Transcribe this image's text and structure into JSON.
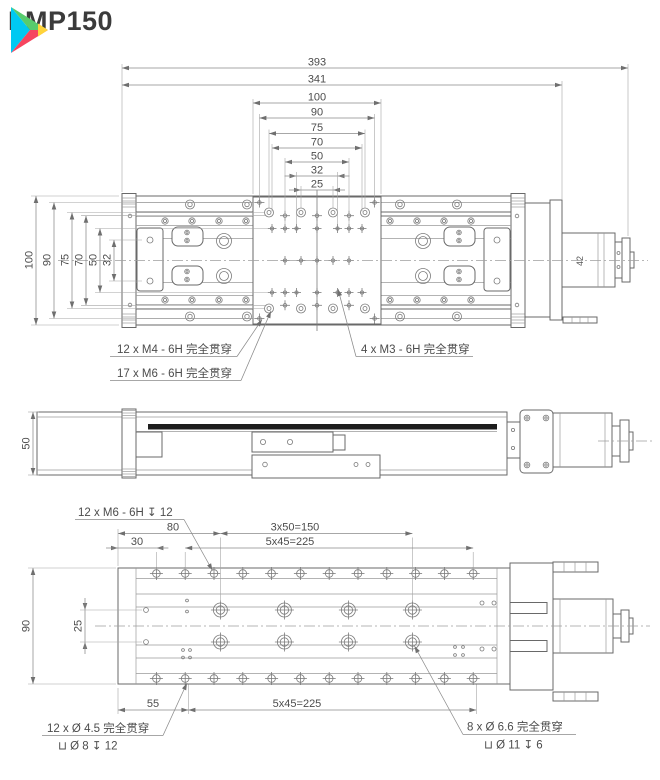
{
  "header": {
    "title": "LMP150",
    "logo_colors": {
      "cyan": "#00c9f2",
      "green": "#57cc6d",
      "yellow": "#ffd43a",
      "red": "#f6455f"
    }
  },
  "views": {
    "top": {
      "hdims": [
        "393",
        "341",
        "100",
        "90",
        "75",
        "70",
        "50",
        "32",
        "25"
      ],
      "vdims": [
        "100",
        "90",
        "75",
        "70",
        "50",
        "32"
      ],
      "notes": [
        "12 x  M4 - 6H 完全贯穿",
        "17 x  M6 - 6H 完全贯穿",
        "4 x  M3 - 6H 完全贯穿"
      ],
      "motor_label": "42"
    },
    "side": {
      "vdims": [
        "50"
      ]
    },
    "bottom": {
      "hdims": [
        "80",
        "30",
        "3x50=150",
        "5x45=225",
        "55",
        "5x45=225"
      ],
      "vdims": [
        "90",
        "25"
      ],
      "notes": [
        "12 x  M6 - 6H ↧ 12",
        "12 x Ø 4.5 完全贯穿",
        "⊔ Ø 8 ↧ 12",
        "8 x Ø 6.6 完全贯穿",
        "⊔ Ø 11 ↧ 6"
      ]
    }
  }
}
